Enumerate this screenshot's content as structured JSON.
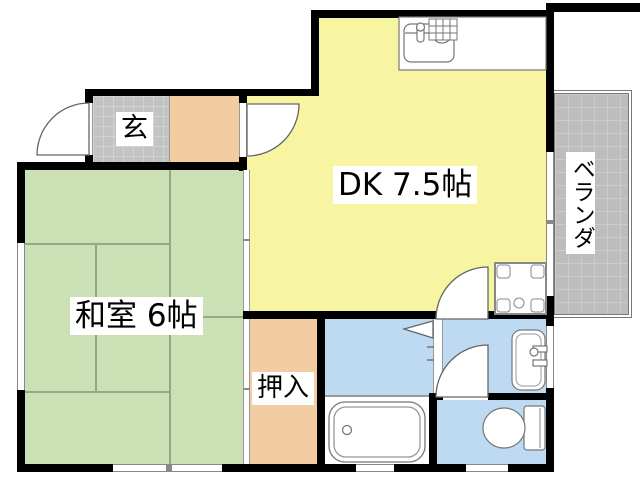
{
  "labels": {
    "entrance": "玄",
    "dining_kitchen": "DK 7.5帖",
    "japanese_room": "和室 6帖",
    "closet": "押入",
    "veranda": "ベランダ"
  },
  "colors": {
    "dk": "#F7F5A2",
    "tatami": "#CCE0B5",
    "tatami_line": "#93A888",
    "peach": "#F2CDA2",
    "wet_blue": "#BDDAF2",
    "tile": "#C3C3C3",
    "tile_line": "#D2D2D2",
    "veranda": "#BDBDBD",
    "veranda_line": "#CBCBCB",
    "wall": "#000000"
  },
  "fixtures": [
    "kitchen-sink",
    "washing-machine-pan",
    "bathtub",
    "washbasin",
    "toilet",
    "entrance-door",
    "kitchen-entry-door",
    "washroom-door",
    "toilet-door",
    "bathroom-folding-door",
    "veranda-window"
  ]
}
